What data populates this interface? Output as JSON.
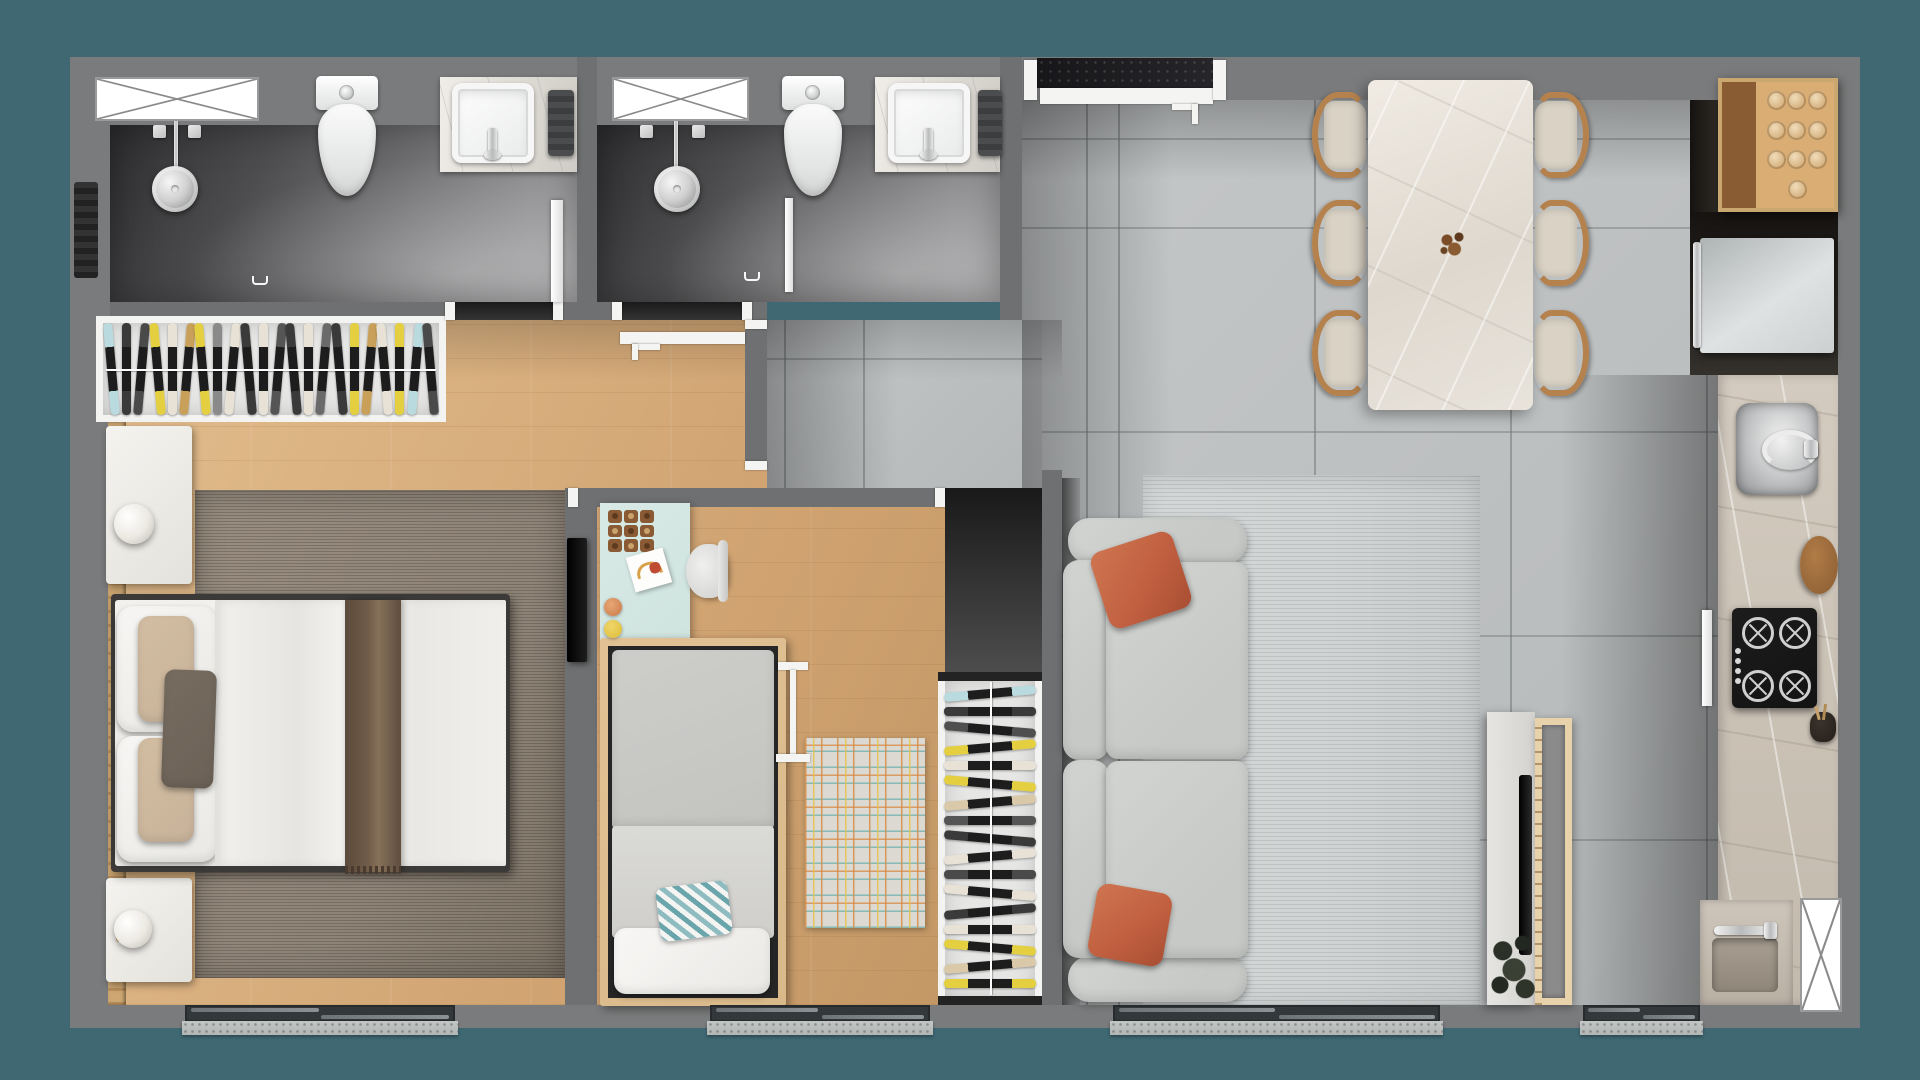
{
  "scene": {
    "title": "apartment-floor-plan-top-view-3d-render",
    "style": "photorealistic top-down architectural render, no visible text",
    "background": "dark teal canvas surrounding grey-walled apartment"
  },
  "palette": {
    "teal": "#3f6873",
    "wall": "#7a7b7c",
    "wallDark": "#6f7071",
    "woodBase": "#d0a371",
    "woodLight": "#e2bd8e",
    "tile": "#b5b8b9",
    "marble": "#dcd8d2",
    "counterMarble": "#cbc2b6",
    "rugMaster": "#8f8478",
    "rugLiving": "#d0d3d3",
    "rugKidsBase": "#dcd8d2",
    "sofa": "#c7c9c7",
    "pillowOrange": "#bf5e3f",
    "duvet": "#edecea",
    "throwBrown": "#6f5b48",
    "pillowBeige": "#c8b39a",
    "pillowAccent": "#6b6156",
    "wardrobeFrame": "#f3f3f2",
    "wardrobeInner": "#e6e6e5",
    "deskMint": "#cfe3df",
    "kidsBedWood": "#d9b98a",
    "stoveBlack": "#131313",
    "graniteDark": "#1a1a1d",
    "threshold": "#b2b6b5",
    "chairWood": "#b5824e",
    "chairSeat": "#d9d2c5",
    "woodCabinet": "#d3a368",
    "fridgeSilver": "#dfe2e2",
    "lampWood": "#cda671",
    "plantDark": "#2c3127"
  },
  "rooms": [
    {
      "id": "bathroom-1",
      "furniture": [
        "window-x",
        "shower-head",
        "shower-valves",
        "toilet",
        "vanity-counter",
        "basin-sink",
        "towel",
        "glass-door",
        "wall-radiator",
        "floor-drain"
      ]
    },
    {
      "id": "bathroom-2",
      "furniture": [
        "window-x",
        "shower-head",
        "shower-valves",
        "glass-partition",
        "toilet",
        "vanity-counter",
        "basin-sink",
        "towel",
        "open-door-leaf",
        "floor-drain"
      ]
    },
    {
      "id": "master-bedroom",
      "furniture": [
        "wardrobe-hanging-clothes",
        "wood-slat-accent-wall",
        "nightstand-with-lamp",
        "nightstand-with-lamp",
        "double-bed-white-duvet-brown-throw",
        "striped-taupe-rug",
        "wall-tv"
      ]
    },
    {
      "id": "kids-bedroom",
      "furniture": [
        "mint-desk",
        "tic-tac-toe-game",
        "drawing-paper",
        "crayon-cups",
        "white-chair",
        "single-bed-wood-frame",
        "chevron-pillow",
        "floor-lamp",
        "checkered-rug",
        "wardrobe-hanging-clothes"
      ]
    },
    {
      "id": "living-dining",
      "furniture": [
        "marble-dining-table",
        "table-centerpiece",
        "dining-chair-x6",
        "grey-sofa",
        "terracotta-pillow-x2",
        "woven-grey-rug",
        "tv-console",
        "edge-on-tv",
        "wood-slat-partition",
        "plant"
      ]
    },
    {
      "id": "kitchen",
      "furniture": [
        "wood-upper-cabinet-with-glasses",
        "fridge",
        "marble-counter",
        "steel-sink-with-faucet",
        "round-cutting-board",
        "gas-cooktop-4-burners",
        "utensil-crock",
        "prep-basin-with-faucet",
        "window-x"
      ]
    }
  ],
  "wardrobes": {
    "master_hangers": [
      "#b9dade",
      "#3a3a3a",
      "#4a4a4a",
      "#e3cf3f",
      "#e8e2d6",
      "#c9a05a",
      "#e3cf3f",
      "#8a8a8a",
      "#e8e2d6",
      "#3a3a3a",
      "#e8e2d6",
      "#555555",
      "#3a3a3a",
      "#e8e2d6",
      "#6a6a6a",
      "#3a3a3a",
      "#e3cf3f",
      "#c9a05a",
      "#e8e2d6",
      "#e3cf3f",
      "#b9dade",
      "#4a4a4a"
    ],
    "kids_hangers": [
      "#b9dade",
      "#3a3a3a",
      "#4f4f4f",
      "#e3cf3f",
      "#e8e2d6",
      "#e3cf3f",
      "#d9c9a8",
      "#555555",
      "#3a3a3a",
      "#e8e2d6",
      "#4a4a4a",
      "#e8e2d6",
      "#3a3a3a",
      "#e8e2d6",
      "#e3cf3f",
      "#d9c9a8",
      "#e3cf3f"
    ]
  },
  "counts": {
    "dining_chairs": 6,
    "stove_burners": 4,
    "stove_knobs": 4,
    "cabinet_glasses": 10,
    "tic_tac_toe_cells": 9,
    "bathroom_windows": 2,
    "exterior_sliding_doors": 4,
    "bathrooms": 2,
    "bedrooms": 2
  }
}
